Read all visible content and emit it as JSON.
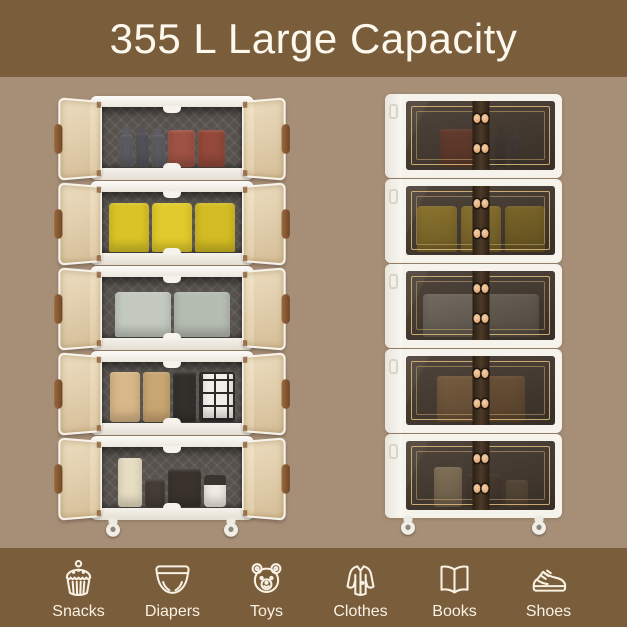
{
  "title": "355 L Large Capacity",
  "colors": {
    "band": "#7a5d3a",
    "background": "#a78e76",
    "title_text": "#fdf8ee",
    "icon_line": "#f8f1e4",
    "cabinet_white": "#f6f3ed",
    "interior_dark": "#57524d",
    "door_champagne": "#e9d7b5",
    "handle_brown": "#8a5a38",
    "glass_tint": "#30241b",
    "gold_trim": "#c9a76c",
    "button_peach": "#edbd92"
  },
  "categories": [
    {
      "label": "Snacks",
      "icon": "cupcake-icon"
    },
    {
      "label": "Diapers",
      "icon": "diaper-icon"
    },
    {
      "label": "Toys",
      "icon": "teddy-bear-icon"
    },
    {
      "label": "Clothes",
      "icon": "coat-icon"
    },
    {
      "label": "Books",
      "icon": "open-book-icon"
    },
    {
      "label": "Shoes",
      "icon": "sneaker-icon"
    }
  ],
  "cabinets": {
    "open": {
      "name": "five-tier-cabinet-doors-open",
      "tiers": [
        {
          "contents": "dark spice bottles and brown pouches",
          "items": [
            {
              "t": "bottle",
              "c": "#5e5d63",
              "w": 13,
              "h": 33
            },
            {
              "t": "bottle",
              "c": "#54535a",
              "w": 13,
              "h": 35
            },
            {
              "t": "bottle",
              "c": "#5e5d63",
              "w": 13,
              "h": 33
            },
            {
              "t": "box",
              "c": "#9d5243",
              "w": 27,
              "h": 37
            },
            {
              "t": "box",
              "c": "#93483a",
              "w": 27,
              "h": 37
            }
          ]
        },
        {
          "contents": "yellow storage bins",
          "items": [
            {
              "t": "bin",
              "c": "#d9c326",
              "w": 40,
              "h": 49
            },
            {
              "t": "bin",
              "c": "#e1cb2c",
              "w": 40,
              "h": 49
            },
            {
              "t": "bin",
              "c": "#d3bc23",
              "w": 40,
              "h": 49
            }
          ]
        },
        {
          "contents": "grey fabric storage bins",
          "items": [
            {
              "t": "bin",
              "c": "#c3c9be",
              "w": 56,
              "h": 45
            },
            {
              "t": "bin",
              "c": "#b5bcb1",
              "w": 56,
              "h": 45
            }
          ]
        },
        {
          "contents": "beige boxes and black-white grid organizers",
          "items": [
            {
              "t": "box",
              "c": "#d8b788",
              "w": 30,
              "h": 50
            },
            {
              "t": "box",
              "c": "#c9a571",
              "w": 27,
              "h": 50
            },
            {
              "t": "box",
              "c": "#33302c",
              "w": 23,
              "h": 50
            },
            {
              "t": "grid",
              "c": "#f1efe9",
              "w": 36,
              "h": 50
            }
          ]
        },
        {
          "contents": "tin box, canister, dark box and white jar",
          "items": [
            {
              "t": "box",
              "c": "#e7ddc2",
              "w": 24,
              "h": 49
            },
            {
              "t": "box",
              "c": "#453d37",
              "w": 20,
              "h": 28
            },
            {
              "t": "box",
              "c": "#3a332d",
              "w": 33,
              "h": 38
            },
            {
              "t": "jar",
              "c": "#f0ebe3",
              "w": 22,
              "h": 31
            }
          ]
        }
      ]
    },
    "closed": {
      "name": "five-tier-cabinet-doors-closed",
      "tiers": [
        {
          "contents": "brown pouch and bottles behind glass",
          "items": [
            {
              "t": "box",
              "c": "#96523f",
              "w": 36,
              "h": 38
            },
            {
              "t": "bottle",
              "c": "#5d5a58",
              "w": 11,
              "h": 31
            },
            {
              "t": "bottle",
              "c": "#545250",
              "w": 11,
              "h": 33
            },
            {
              "t": "bottle",
              "c": "#5d5a58",
              "w": 11,
              "h": 31
            }
          ]
        },
        {
          "contents": "yellow bins behind glass",
          "items": [
            {
              "t": "bin",
              "c": "#d6b63a",
              "w": 40,
              "h": 46
            },
            {
              "t": "bin",
              "c": "#ddbd40",
              "w": 40,
              "h": 46
            },
            {
              "t": "bin",
              "c": "#cfb036",
              "w": 40,
              "h": 46
            }
          ]
        },
        {
          "contents": "grey bins behind glass",
          "items": [
            {
              "t": "bin",
              "c": "#aaa89d",
              "w": 56,
              "h": 43
            },
            {
              "t": "bin",
              "c": "#9f9d92",
              "w": 56,
              "h": 43
            }
          ]
        },
        {
          "contents": "beige boxes behind glass",
          "items": [
            {
              "t": "box",
              "c": "#b58d5d",
              "w": 44,
              "h": 46
            },
            {
              "t": "box",
              "c": "#a67f52",
              "w": 40,
              "h": 46
            }
          ]
        },
        {
          "contents": "boxes and jars behind glass",
          "items": [
            {
              "t": "box",
              "c": "#ccb892",
              "w": 28,
              "h": 40
            },
            {
              "t": "box",
              "c": "#615448",
              "w": 36,
              "h": 33
            },
            {
              "t": "box",
              "c": "#8f7d63",
              "w": 22,
              "h": 27
            }
          ]
        }
      ]
    }
  }
}
